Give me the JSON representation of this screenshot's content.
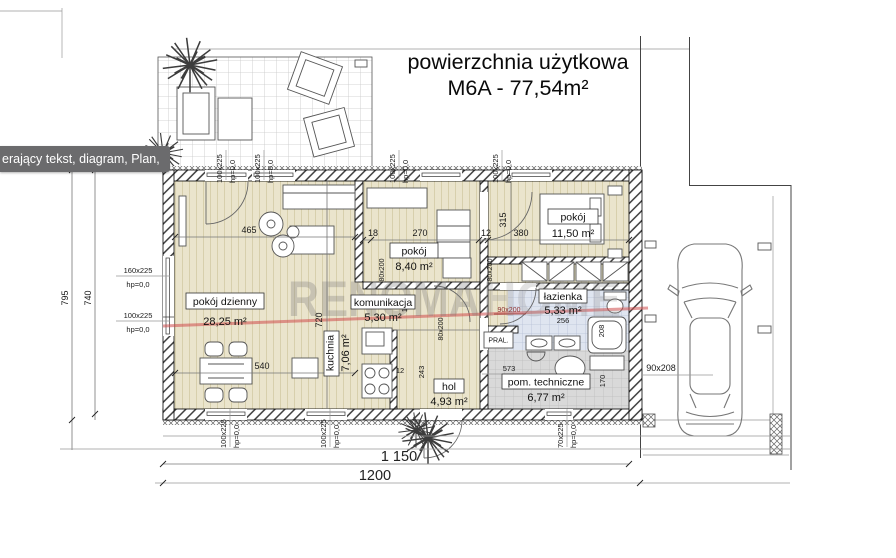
{
  "title": {
    "line1": "powierzchnia użytkowa",
    "line2": "M6A - 77,54m²"
  },
  "tooltip": {
    "text": "erający tekst, diagram, Plan,"
  },
  "watermark": {
    "part1": "RENOMA",
    "part2": "HOME"
  },
  "rooms": {
    "living": {
      "name": "pokój dzienny",
      "area": "28,25 m²"
    },
    "room1": {
      "name": "pokój",
      "area": "8,40 m²"
    },
    "room2": {
      "name": "pokój",
      "area": "11,50 m²"
    },
    "hall": {
      "name": "komunikacja",
      "area": "5,30 m²"
    },
    "kitchen": {
      "name": "kuchnia",
      "area": "7,06 m²"
    },
    "entry": {
      "name": "hol",
      "area": "4,93 m²"
    },
    "bath": {
      "name": "łazienka",
      "area": "5,33 m²"
    },
    "tech": {
      "name": "pom. techniczne",
      "area": "6,77 m²"
    }
  },
  "labels": {
    "washer": "PRAL."
  },
  "dims": {
    "left_outer": "795",
    "left_inner": "740",
    "bottom_inner": "1 150",
    "bottom_outer": "1200",
    "living_w": "465",
    "living_h": "720",
    "dining_w": "540",
    "d18": "18",
    "d270": "270",
    "d12": "12",
    "d380": "380",
    "d315": "315",
    "d135": "135",
    "d243": "243",
    "d12b": "12",
    "d573": "573",
    "d170": "170",
    "d208": "208",
    "d256": "256",
    "car": "90x208"
  },
  "openings": {
    "w100": "100x225",
    "w160": "160x225",
    "w70": "70x225",
    "hp": "hp=0,0",
    "door80": "80x200",
    "door90": "90x200"
  },
  "colors": {
    "floor": "#eae4cc",
    "bath_tile": "#dfe5f0",
    "tech_tile": "#d9d9d9",
    "watermark_line": "#cd4b4b",
    "tooltip_bg": "#6b6b6d"
  }
}
